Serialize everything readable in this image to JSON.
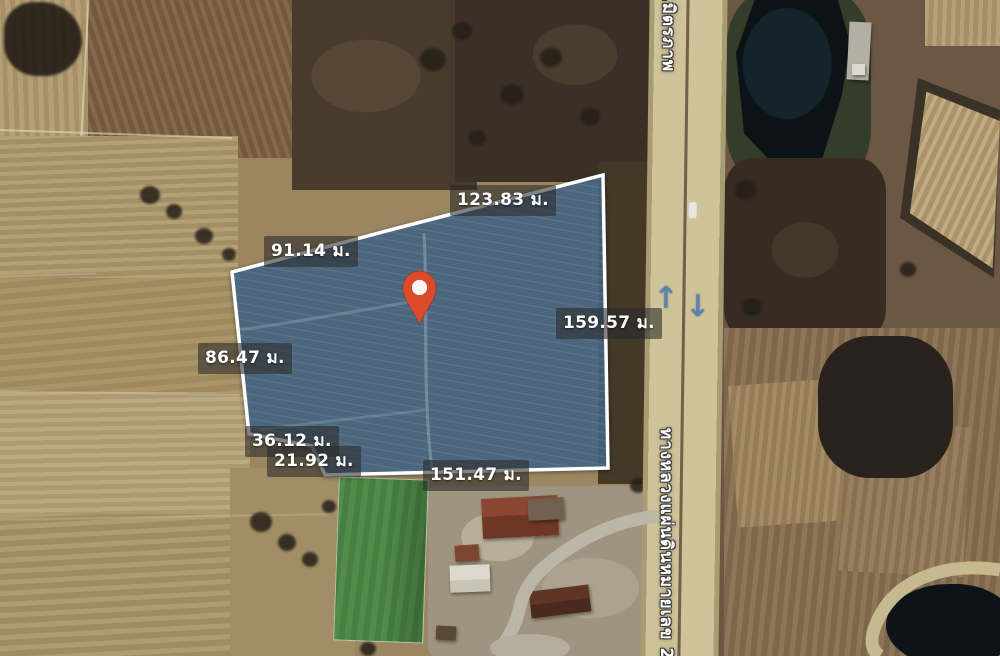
{
  "map": {
    "type": "satellite",
    "plot_outline": {
      "fill_color": "#4a6d8c",
      "border_color": "#ffffff",
      "measurements": {
        "top_left": "91.14 ม.",
        "top_right": "123.83 ม.",
        "right": "159.57 ม.",
        "left": "86.47 ม.",
        "notch_upper": "36.12 ม.",
        "notch_lower": "21.92 ม.",
        "bottom": "151.47 ม."
      }
    },
    "marker": {
      "kind": "location-pin",
      "color": "#db4a2b"
    },
    "road": {
      "name_top": "ถ.มิตรภาพ",
      "name_bottom": "ทางหลวงแผ่นดินหมายเลข 2",
      "direction_arrows": {
        "up": "↑",
        "down": "↓"
      }
    }
  }
}
